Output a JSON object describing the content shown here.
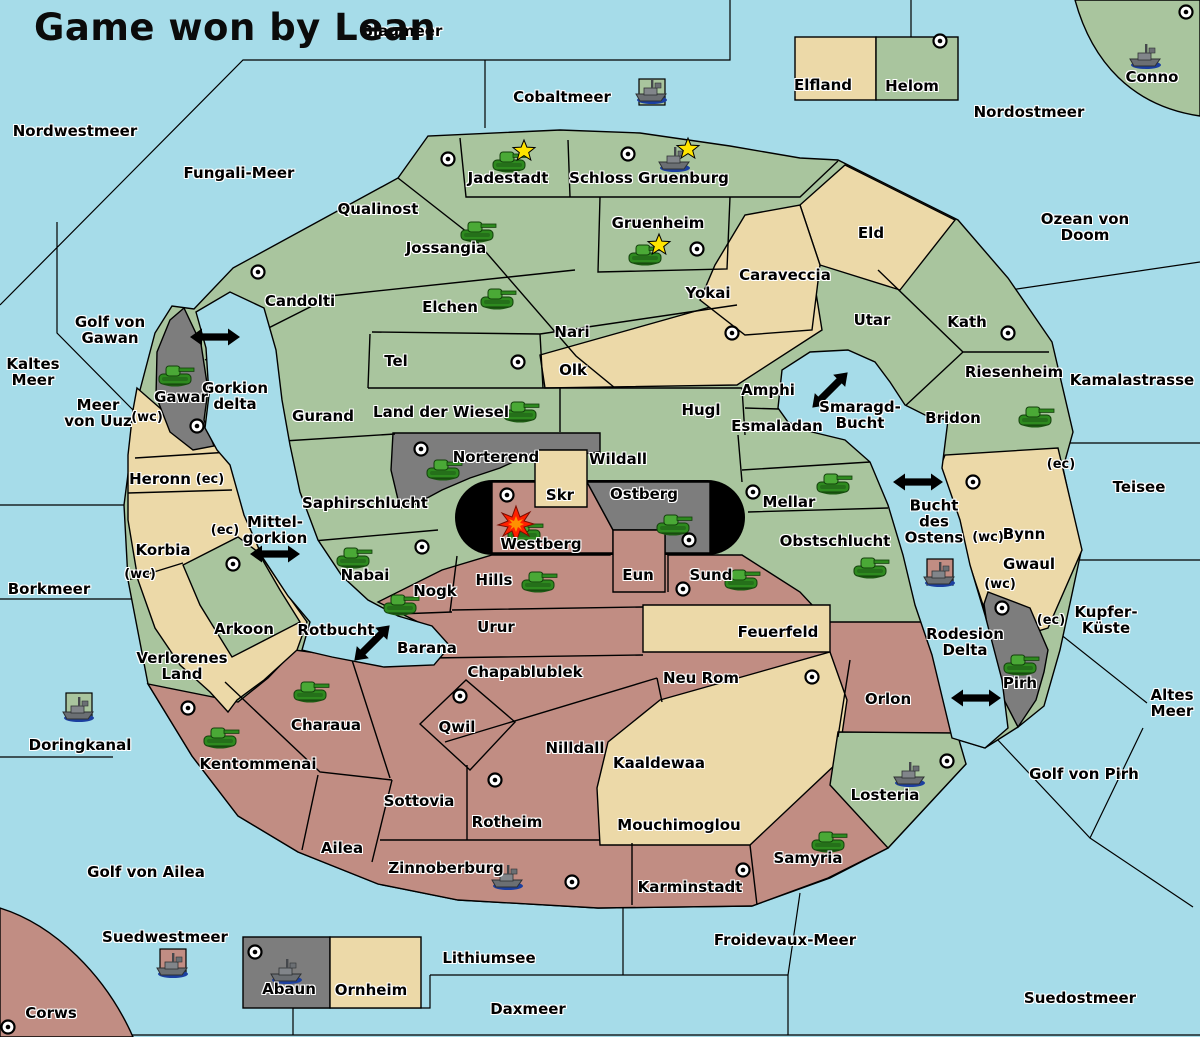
{
  "title": "Game won by Lean",
  "winner": "Lean",
  "colors": {
    "sea": "#a6dce9",
    "land_green": "#a9c59e",
    "land_tan": "#ecd9a8",
    "land_pink": "#c18d83",
    "land_gray": "#7d7d7d",
    "black_zone": "#000000",
    "tank_green": "#2e8a1f",
    "ship_gray": "#6b6f73",
    "star_yellow": "#ffe400",
    "explosion_red": "#ff2000",
    "outline": "#000000"
  },
  "map": {
    "sea_labels": [
      {
        "id": "blaumeer",
        "text": "Blaumeer",
        "x": 402,
        "y": 31
      },
      {
        "id": "nordwestmeer",
        "text": "Nordwestmeer",
        "x": 75,
        "y": 131
      },
      {
        "id": "cobaltmeer",
        "text": "Cobaltmeer",
        "x": 562,
        "y": 97
      },
      {
        "id": "nordostmeer",
        "text": "Nordostmeer",
        "x": 1029,
        "y": 112
      },
      {
        "id": "fungali-meer",
        "text": "Fungali-Meer",
        "x": 239,
        "y": 173
      },
      {
        "id": "ozean-von-doom",
        "text": "Ozean von Doom",
        "x": 1085,
        "y": 227
      },
      {
        "id": "kaltes-meer",
        "text": "Kaltes\nMeer",
        "x": 33,
        "y": 372
      },
      {
        "id": "golf-von-gawan",
        "text": "Golf von\nGawan",
        "x": 110,
        "y": 330
      },
      {
        "id": "meer-von-uuz",
        "text": "Meer\nvon Uuz",
        "x": 98,
        "y": 413
      },
      {
        "id": "gorkion-delta",
        "text": "Gorkion\ndelta",
        "x": 235,
        "y": 396
      },
      {
        "id": "kamalastrasse",
        "text": "Kamalastrasse",
        "x": 1132,
        "y": 380
      },
      {
        "id": "smaragd-bucht",
        "text": "Smaragd-\nBucht",
        "x": 860,
        "y": 415
      },
      {
        "id": "mittel-gorkion",
        "text": "Mittel-\ngorkion",
        "x": 275,
        "y": 530
      },
      {
        "id": "bucht-des-ostens",
        "text": "Bucht\ndes\nOstens",
        "x": 934,
        "y": 522
      },
      {
        "id": "teisee",
        "text": "Teisee",
        "x": 1139,
        "y": 487
      },
      {
        "id": "borkmeer",
        "text": "Borkmeer",
        "x": 49,
        "y": 589
      },
      {
        "id": "rotbucht",
        "text": "Rotbucht",
        "x": 336,
        "y": 630
      },
      {
        "id": "kupfer-kueste",
        "text": "Kupfer-\nKüste",
        "x": 1106,
        "y": 620
      },
      {
        "id": "altes-meer",
        "text": "Altes\nMeer",
        "x": 1172,
        "y": 703
      },
      {
        "id": "rodesion-delta",
        "text": "Rodesion\nDelta",
        "x": 965,
        "y": 642
      },
      {
        "id": "doringkanal",
        "text": "Doringkanal",
        "x": 80,
        "y": 745
      },
      {
        "id": "golf-von-pirh",
        "text": "Golf von Pirh",
        "x": 1084,
        "y": 774
      },
      {
        "id": "golf-von-ailea",
        "text": "Golf von Ailea",
        "x": 146,
        "y": 872
      },
      {
        "id": "suedwestmeer",
        "text": "Suedwestmeer",
        "x": 165,
        "y": 937
      },
      {
        "id": "froidevaux-meer",
        "text": "Froidevaux-Meer",
        "x": 785,
        "y": 940
      },
      {
        "id": "lithiumsee",
        "text": "Lithiumsee",
        "x": 489,
        "y": 958
      },
      {
        "id": "daxmeer",
        "text": "Daxmeer",
        "x": 528,
        "y": 1009
      },
      {
        "id": "suedostmeer",
        "text": "Suedostmeer",
        "x": 1080,
        "y": 998
      }
    ],
    "region_labels": [
      {
        "id": "elfland",
        "text": "Elfland",
        "x": 823,
        "y": 85
      },
      {
        "id": "helom",
        "text": "Helom",
        "x": 912,
        "y": 86
      },
      {
        "id": "conno",
        "text": "Conno",
        "x": 1152,
        "y": 77
      },
      {
        "id": "jadestadt",
        "text": "Jadestadt",
        "x": 508,
        "y": 178
      },
      {
        "id": "schloss-gruenburg",
        "text": "Schloss Gruenburg",
        "x": 649,
        "y": 178
      },
      {
        "id": "qualinost",
        "text": "Qualinost",
        "x": 378,
        "y": 209
      },
      {
        "id": "jossangia",
        "text": "Jossangia",
        "x": 446,
        "y": 248
      },
      {
        "id": "gruenheim",
        "text": "Gruenheim",
        "x": 658,
        "y": 223
      },
      {
        "id": "caraveccia",
        "text": "Caraveccia",
        "x": 785,
        "y": 275
      },
      {
        "id": "eld",
        "text": "Eld",
        "x": 871,
        "y": 233
      },
      {
        "id": "yokai",
        "text": "Yokai",
        "x": 708,
        "y": 293
      },
      {
        "id": "candolti",
        "text": "Candolti",
        "x": 300,
        "y": 301
      },
      {
        "id": "elchen",
        "text": "Elchen",
        "x": 450,
        "y": 307
      },
      {
        "id": "nari",
        "text": "Nari",
        "x": 572,
        "y": 332
      },
      {
        "id": "utar",
        "text": "Utar",
        "x": 872,
        "y": 320
      },
      {
        "id": "kath",
        "text": "Kath",
        "x": 967,
        "y": 322
      },
      {
        "id": "tel",
        "text": "Tel",
        "x": 396,
        "y": 361
      },
      {
        "id": "olk",
        "text": "Olk",
        "x": 573,
        "y": 370
      },
      {
        "id": "riesenheim",
        "text": "Riesenheim",
        "x": 1014,
        "y": 372
      },
      {
        "id": "gurand",
        "text": "Gurand",
        "x": 323,
        "y": 416
      },
      {
        "id": "land-der-wiesel",
        "text": "Land der Wiesel",
        "x": 441,
        "y": 412
      },
      {
        "id": "hugl",
        "text": "Hugl",
        "x": 701,
        "y": 410
      },
      {
        "id": "amphi",
        "text": "Amphi",
        "x": 768,
        "y": 390
      },
      {
        "id": "esmaladan",
        "text": "Esmaladan",
        "x": 777,
        "y": 426
      },
      {
        "id": "bridon",
        "text": "Bridon",
        "x": 953,
        "y": 418
      },
      {
        "id": "gawar",
        "text": "Gawar",
        "x": 181,
        "y": 397
      },
      {
        "id": "heronn",
        "text": "Heronn",
        "x": 160,
        "y": 479
      },
      {
        "id": "norterend",
        "text": "Norterend",
        "x": 496,
        "y": 457
      },
      {
        "id": "wildall",
        "text": "Wildall",
        "x": 618,
        "y": 459
      },
      {
        "id": "skr",
        "text": "Skr",
        "x": 560,
        "y": 495
      },
      {
        "id": "ostberg",
        "text": "Ostberg",
        "x": 644,
        "y": 494
      },
      {
        "id": "saphirschlucht",
        "text": "Saphirschlucht",
        "x": 365,
        "y": 503
      },
      {
        "id": "mellar",
        "text": "Mellar",
        "x": 789,
        "y": 502
      },
      {
        "id": "westberg",
        "text": "Westberg",
        "x": 541,
        "y": 544
      },
      {
        "id": "korbia",
        "text": "Korbia",
        "x": 163,
        "y": 550
      },
      {
        "id": "obstschlucht",
        "text": "Obstschlucht",
        "x": 835,
        "y": 541
      },
      {
        "id": "nabai",
        "text": "Nabai",
        "x": 365,
        "y": 575
      },
      {
        "id": "hills",
        "text": "Hills",
        "x": 494,
        "y": 580
      },
      {
        "id": "eun",
        "text": "Eun",
        "x": 638,
        "y": 575
      },
      {
        "id": "sund",
        "text": "Sund",
        "x": 711,
        "y": 575
      },
      {
        "id": "bynn",
        "text": "Bynn",
        "x": 1024,
        "y": 534
      },
      {
        "id": "gwaul",
        "text": "Gwaul",
        "x": 1029,
        "y": 564
      },
      {
        "id": "nogk",
        "text": "Nogk",
        "x": 435,
        "y": 591
      },
      {
        "id": "arkoon",
        "text": "Arkoon",
        "x": 244,
        "y": 629
      },
      {
        "id": "urur",
        "text": "Urur",
        "x": 496,
        "y": 627
      },
      {
        "id": "feuerfeld",
        "text": "Feuerfeld",
        "x": 778,
        "y": 632
      },
      {
        "id": "barana",
        "text": "Barana",
        "x": 427,
        "y": 648
      },
      {
        "id": "verlorenes-land",
        "text": "Verlorenes\nLand",
        "x": 182,
        "y": 666
      },
      {
        "id": "chapablublek",
        "text": "Chapablublek",
        "x": 525,
        "y": 672
      },
      {
        "id": "neu-rom",
        "text": "Neu Rom",
        "x": 701,
        "y": 678
      },
      {
        "id": "orlon",
        "text": "Orlon",
        "x": 888,
        "y": 699
      },
      {
        "id": "pirh",
        "text": "Pirh",
        "x": 1020,
        "y": 683
      },
      {
        "id": "charaua",
        "text": "Charaua",
        "x": 326,
        "y": 725
      },
      {
        "id": "qwil",
        "text": "Qwil",
        "x": 457,
        "y": 727
      },
      {
        "id": "kentommenai",
        "text": "Kentommenai",
        "x": 258,
        "y": 764
      },
      {
        "id": "nilldall",
        "text": "Nilldall",
        "x": 575,
        "y": 748
      },
      {
        "id": "kaaldewaa",
        "text": "Kaaldewaa",
        "x": 659,
        "y": 763
      },
      {
        "id": "sottovia",
        "text": "Sottovia",
        "x": 419,
        "y": 801
      },
      {
        "id": "rotheim",
        "text": "Rotheim",
        "x": 507,
        "y": 822
      },
      {
        "id": "mouchimoglou",
        "text": "Mouchimoglou",
        "x": 679,
        "y": 825
      },
      {
        "id": "losteria",
        "text": "Losteria",
        "x": 885,
        "y": 795
      },
      {
        "id": "samyria",
        "text": "Samyria",
        "x": 808,
        "y": 858
      },
      {
        "id": "ailea",
        "text": "Ailea",
        "x": 342,
        "y": 848
      },
      {
        "id": "zinnoberburg",
        "text": "Zinnoberburg",
        "x": 446,
        "y": 868
      },
      {
        "id": "karminstadt",
        "text": "Karminstadt",
        "x": 690,
        "y": 887
      },
      {
        "id": "abaun",
        "text": "Abaun",
        "x": 289,
        "y": 989
      },
      {
        "id": "ornheim",
        "text": "Ornheim",
        "x": 371,
        "y": 990
      },
      {
        "id": "corws",
        "text": "Corws",
        "x": 51,
        "y": 1013
      }
    ],
    "small_labels": [
      {
        "id": "wc-uuz",
        "text": "(wc)",
        "x": 147,
        "y": 418
      },
      {
        "id": "ec-heronn",
        "text": "(ec)",
        "x": 210,
        "y": 480
      },
      {
        "id": "ec-korbia",
        "text": "(ec)",
        "x": 225,
        "y": 531
      },
      {
        "id": "wc-korbia",
        "text": "(wc)",
        "x": 140,
        "y": 575
      },
      {
        "id": "ec-bynn",
        "text": "(ec)",
        "x": 1061,
        "y": 465
      },
      {
        "id": "wc-bynn",
        "text": "(wc)",
        "x": 988,
        "y": 538
      },
      {
        "id": "wc-gwaul",
        "text": "(wc)",
        "x": 1000,
        "y": 585
      },
      {
        "id": "ec-kupfer",
        "text": "(ec)",
        "x": 1051,
        "y": 621
      }
    ],
    "units": {
      "tanks": [
        [
          509,
          160
        ],
        [
          477,
          230
        ],
        [
          645,
          253
        ],
        [
          497,
          297
        ],
        [
          520,
          410
        ],
        [
          175,
          374
        ],
        [
          443,
          468
        ],
        [
          673,
          523
        ],
        [
          833,
          482
        ],
        [
          870,
          566
        ],
        [
          1035,
          415
        ],
        [
          353,
          556
        ],
        [
          524,
          530
        ],
        [
          538,
          580
        ],
        [
          741,
          578
        ],
        [
          400,
          603
        ],
        [
          310,
          690
        ],
        [
          220,
          736
        ],
        [
          828,
          840
        ],
        [
          1020,
          663
        ]
      ],
      "ships": [
        [
          652,
          92
        ],
        [
          1146,
          57
        ],
        [
          675,
          160
        ],
        [
          940,
          575
        ],
        [
          910,
          775
        ],
        [
          508,
          878
        ],
        [
          79,
          710
        ],
        [
          173,
          966
        ],
        [
          287,
          972
        ]
      ],
      "stars": [
        [
          524,
          151
        ],
        [
          688,
          149
        ],
        [
          659,
          245
        ]
      ],
      "cities": [
        [
          940,
          41
        ],
        [
          1186,
          12
        ],
        [
          448,
          159
        ],
        [
          628,
          154
        ],
        [
          258,
          272
        ],
        [
          697,
          249
        ],
        [
          518,
          362
        ],
        [
          732,
          333
        ],
        [
          1008,
          333
        ],
        [
          197,
          426
        ],
        [
          421,
          449
        ],
        [
          422,
          547
        ],
        [
          507,
          495
        ],
        [
          689,
          540
        ],
        [
          753,
          492
        ],
        [
          973,
          482
        ],
        [
          233,
          564
        ],
        [
          683,
          589
        ],
        [
          460,
          696
        ],
        [
          812,
          677
        ],
        [
          188,
          708
        ],
        [
          495,
          780
        ],
        [
          572,
          882
        ],
        [
          743,
          870
        ],
        [
          947,
          761
        ],
        [
          1002,
          608
        ],
        [
          8,
          1027
        ],
        [
          255,
          952
        ]
      ],
      "explosions": [
        [
          516,
          524
        ]
      ],
      "arrows": [
        [
          215,
          337,
          0
        ],
        [
          275,
          554,
          0
        ],
        [
          372,
          643,
          -45
        ],
        [
          830,
          390,
          -45
        ],
        [
          918,
          482,
          0
        ],
        [
          976,
          698,
          0
        ]
      ]
    },
    "tiles": [
      {
        "x": 652,
        "y": 92,
        "color": "green"
      },
      {
        "x": 940,
        "y": 572,
        "color": "pink"
      },
      {
        "x": 79,
        "y": 706,
        "color": "green"
      },
      {
        "x": 173,
        "y": 962,
        "color": "pink"
      }
    ]
  }
}
